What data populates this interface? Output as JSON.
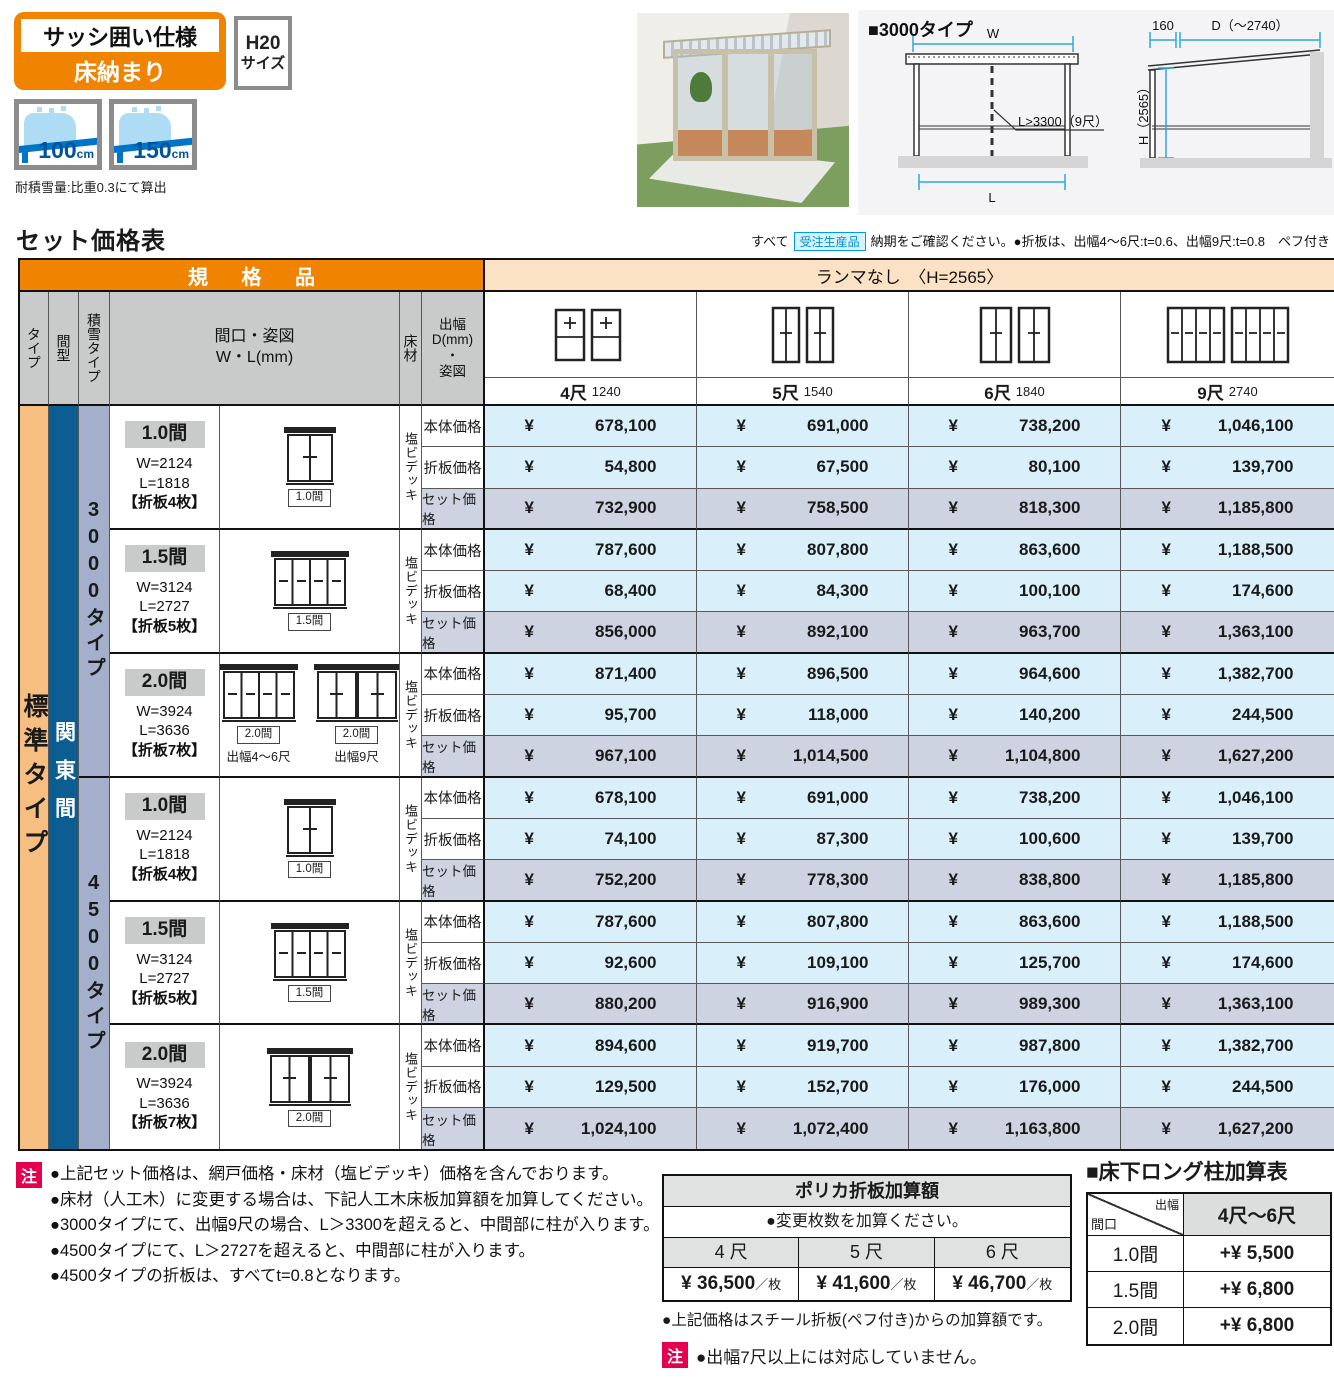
{
  "header": {
    "spec_badge": {
      "line1": "サッシ囲い仕様",
      "line2": "床納まり"
    },
    "size_badge": {
      "line1": "H20",
      "line2": "サイズ"
    },
    "snow": [
      {
        "value": "100",
        "unit": "cm"
      },
      {
        "value": "150",
        "unit": "cm"
      }
    ],
    "snow_note": "耐積雪量:比重0.3にて算出",
    "diagram": {
      "title": "■3000タイプ",
      "w": "W",
      "l": "L",
      "callout": "L>3300（9尺）",
      "d160": "160",
      "d": "D（～2740）",
      "h": "H（2565）"
    }
  },
  "price_section": {
    "title": "セット価格表",
    "note_prefix": "すべて",
    "order_badge": "受注生産品",
    "note_suffix": "納期をご確認ください。●折板は、出幅4～6尺:t=0.6、出幅9尺:t=0.8　ペフ付き"
  },
  "table": {
    "group_left": "規 格 品",
    "group_right": "ランマなし　〈H=2565〉",
    "headers": {
      "type": "タイプ",
      "span": "間型",
      "snow": "積雪タイプ",
      "spec_line1": "間口・姿図",
      "spec_line2": "W・L(mm)",
      "floor": "床材",
      "depth_lines": [
        "出幅",
        "D(mm)",
        "・",
        "姿図"
      ]
    },
    "size_cols": [
      {
        "label": "4尺",
        "mm": "1240",
        "icon": "pair-upper"
      },
      {
        "label": "5尺",
        "mm": "1540",
        "icon": "pair-tall"
      },
      {
        "label": "6尺",
        "mm": "1840",
        "icon": "pair-tall-wide"
      },
      {
        "label": "9尺",
        "mm": "2740",
        "icon": "pair-wide"
      }
    ],
    "type_label": "標準タイプ",
    "span_label": "関東間",
    "floor_label": "塩ビデッキ",
    "currency": "¥",
    "sections": [
      {
        "snow_type": "3000タイプ",
        "subs": [
          {
            "size": "1.0間",
            "dims": [
              "W=2124",
              "L=1818",
              "【折板4枚】"
            ],
            "diagrams": [
              {
                "label": "1.0間",
                "caption": "",
                "style": "w2"
              }
            ],
            "rows": [
              {
                "label": "本体価格",
                "values": [
                  "678,100",
                  "691,000",
                  "738,200",
                  "1,046,100"
                ]
              },
              {
                "label": "折板価格",
                "values": [
                  "54,800",
                  "67,500",
                  "80,100",
                  "139,700"
                ]
              },
              {
                "label": "セット価格",
                "values": [
                  "732,900",
                  "758,500",
                  "818,300",
                  "1,185,800"
                ]
              }
            ]
          },
          {
            "size": "1.5間",
            "dims": [
              "W=3124",
              "L=2727",
              "【折板5枚】"
            ],
            "diagrams": [
              {
                "label": "1.5間",
                "caption": "",
                "style": "w4"
              }
            ],
            "rows": [
              {
                "label": "本体価格",
                "values": [
                  "787,600",
                  "807,800",
                  "863,600",
                  "1,188,500"
                ]
              },
              {
                "label": "折板価格",
                "values": [
                  "68,400",
                  "84,300",
                  "100,100",
                  "174,600"
                ]
              },
              {
                "label": "セット価格",
                "values": [
                  "856,000",
                  "892,100",
                  "963,700",
                  "1,363,100"
                ]
              }
            ]
          },
          {
            "size": "2.0間",
            "dims": [
              "W=3924",
              "L=3636",
              "【折板7枚】"
            ],
            "diagrams": [
              {
                "label": "2.0間",
                "caption": "出幅4～6尺",
                "style": "w4"
              },
              {
                "label": "2.0間",
                "caption": "出幅9尺",
                "style": "w22"
              }
            ],
            "rows": [
              {
                "label": "本体価格",
                "values": [
                  "871,400",
                  "896,500",
                  "964,600",
                  "1,382,700"
                ]
              },
              {
                "label": "折板価格",
                "values": [
                  "95,700",
                  "118,000",
                  "140,200",
                  "244,500"
                ]
              },
              {
                "label": "セット価格",
                "values": [
                  "967,100",
                  "1,014,500",
                  "1,104,800",
                  "1,627,200"
                ]
              }
            ]
          }
        ]
      },
      {
        "snow_type": "4500タイプ",
        "subs": [
          {
            "size": "1.0間",
            "dims": [
              "W=2124",
              "L=1818",
              "【折板4枚】"
            ],
            "diagrams": [
              {
                "label": "1.0間",
                "caption": "",
                "style": "w2"
              }
            ],
            "rows": [
              {
                "label": "本体価格",
                "values": [
                  "678,100",
                  "691,000",
                  "738,200",
                  "1,046,100"
                ]
              },
              {
                "label": "折板価格",
                "values": [
                  "74,100",
                  "87,300",
                  "100,600",
                  "139,700"
                ]
              },
              {
                "label": "セット価格",
                "values": [
                  "752,200",
                  "778,300",
                  "838,800",
                  "1,185,800"
                ]
              }
            ]
          },
          {
            "size": "1.5間",
            "dims": [
              "W=3124",
              "L=2727",
              "【折板5枚】"
            ],
            "diagrams": [
              {
                "label": "1.5間",
                "caption": "",
                "style": "w4"
              }
            ],
            "rows": [
              {
                "label": "本体価格",
                "values": [
                  "787,600",
                  "807,800",
                  "863,600",
                  "1,188,500"
                ]
              },
              {
                "label": "折板価格",
                "values": [
                  "92,600",
                  "109,100",
                  "125,700",
                  "174,600"
                ]
              },
              {
                "label": "セット価格",
                "values": [
                  "880,200",
                  "916,900",
                  "989,300",
                  "1,363,100"
                ]
              }
            ]
          },
          {
            "size": "2.0間",
            "dims": [
              "W=3924",
              "L=3636",
              "【折板7枚】"
            ],
            "diagrams": [
              {
                "label": "2.0間",
                "caption": "",
                "style": "w22"
              }
            ],
            "rows": [
              {
                "label": "本体価格",
                "values": [
                  "894,600",
                  "919,700",
                  "987,800",
                  "1,382,700"
                ]
              },
              {
                "label": "折板価格",
                "values": [
                  "129,500",
                  "152,700",
                  "176,000",
                  "244,500"
                ]
              },
              {
                "label": "セット価格",
                "values": [
                  "1,024,100",
                  "1,072,400",
                  "1,163,800",
                  "1,627,200"
                ]
              }
            ]
          }
        ]
      }
    ]
  },
  "notes": {
    "badge": "注",
    "items": [
      "●上記セット価格は、網戸価格・床材（塩ビデッキ）価格を含んでおります。",
      "●床材（人工木）に変更する場合は、下記人工木床板加算額を加算してください。",
      "●3000タイプにて、出幅9尺の場合、L＞3300を超えると、中間部に柱が入ります。",
      "●4500タイプにて、L＞2727を超えると、中間部に柱が入ります。",
      "●4500タイプの折板は、すべてt=0.8となります。"
    ]
  },
  "polyca": {
    "title": "ポリカ折板加算額",
    "note": "●変更枚数を加算ください。",
    "cols": [
      "4 尺",
      "5 尺",
      "6 尺"
    ],
    "values": [
      {
        "price": "¥ 36,500",
        "unit": "／枚"
      },
      {
        "price": "¥ 41,600",
        "unit": "／枚"
      },
      {
        "price": "¥ 46,700",
        "unit": "／枚"
      }
    ],
    "footnote": "●上記価格はスチール折板(ペフ付き)からの加算額です。",
    "caution_badge": "注",
    "caution": "●出幅7尺以上には対応していません。"
  },
  "long_pillar": {
    "title": "■床下ロング柱加算表",
    "diag": {
      "top_right": "出幅",
      "bottom_left": "間口"
    },
    "col": "4尺～6尺",
    "rows": [
      {
        "maguchi": "1.0間",
        "add": "+¥ 5,500"
      },
      {
        "maguchi": "1.5間",
        "add": "+¥ 6,800"
      },
      {
        "maguchi": "2.0間",
        "add": "+¥ 6,800"
      }
    ]
  }
}
